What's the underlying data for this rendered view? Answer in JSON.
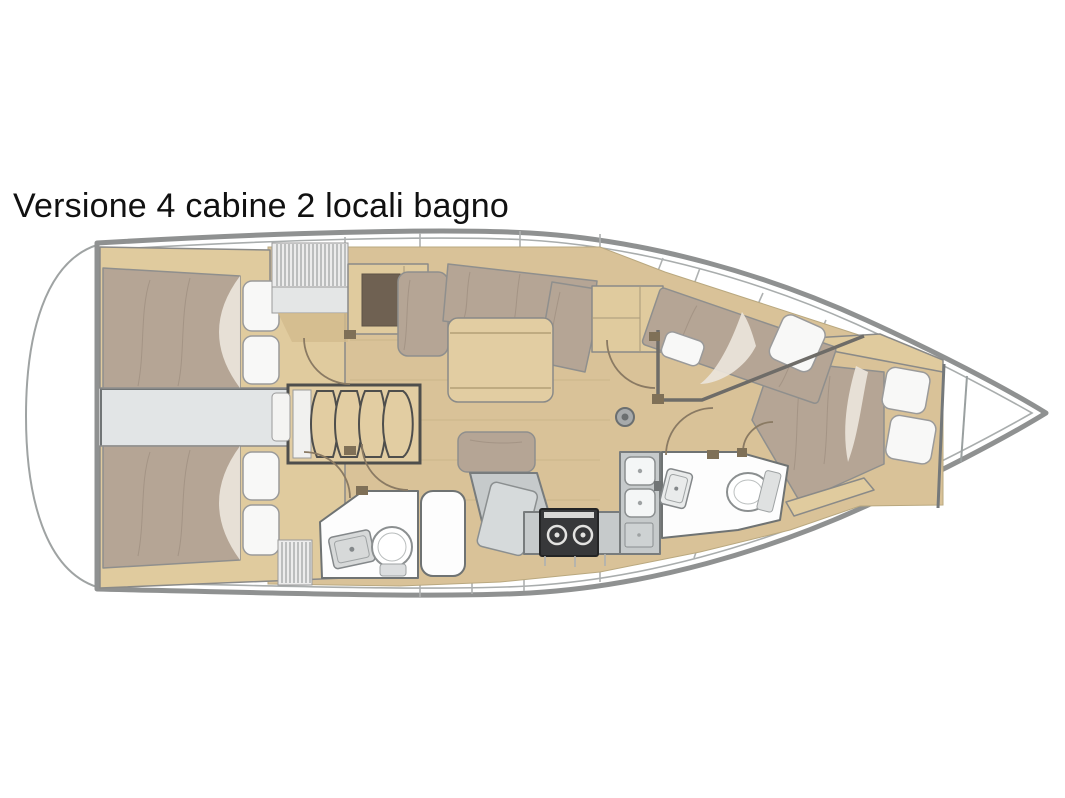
{
  "title": "Versione 4 cabine 2 locali bagno",
  "diagram": {
    "kind": "sailboat-interior-floor-plan",
    "bow_direction": "right",
    "cabins": 4,
    "bathrooms": 2,
    "features": [
      "aft-cabin-port-double-bed",
      "aft-cabin-starboard-double-bed",
      "engine-compartment",
      "companionway-stairs",
      "companionway-hatch",
      "salon-settee",
      "salon-table",
      "chart-table",
      "chart-table-seat",
      "galley-stove",
      "galley-double-sink",
      "aft-head-toilet",
      "aft-head-sink",
      "aft-head-shower",
      "forward-head-toilet",
      "forward-head-sink",
      "forward-cabin-port-bed",
      "bow-cabin-v-berth",
      "mast-foot",
      "anchor-locker",
      "swim-platform"
    ]
  },
  "colors": {
    "hull": "#8f9191",
    "deck_line": "#a9adad",
    "wood_floor": "#d9c298",
    "wood_cabinet": "#e0cb9e",
    "wood_light": "#e2cda2",
    "panel_brown": "#6f6152",
    "mattress": "#b5a595",
    "mattress_shade": "#9c8d7f",
    "pillow": "#f8f8f7",
    "pillow_outline": "#9a9a9a",
    "drape": "#ece5db",
    "gray_zone": "#e2e5e6",
    "gray_border": "#717576",
    "counter": "#c6cacb",
    "white_room": "#fdfdfd",
    "room_border": "#6f7373",
    "stove_black": "#37383a",
    "door_arc": "#8a7a63",
    "wall": "#6e6c68",
    "title_text": "#111111"
  }
}
